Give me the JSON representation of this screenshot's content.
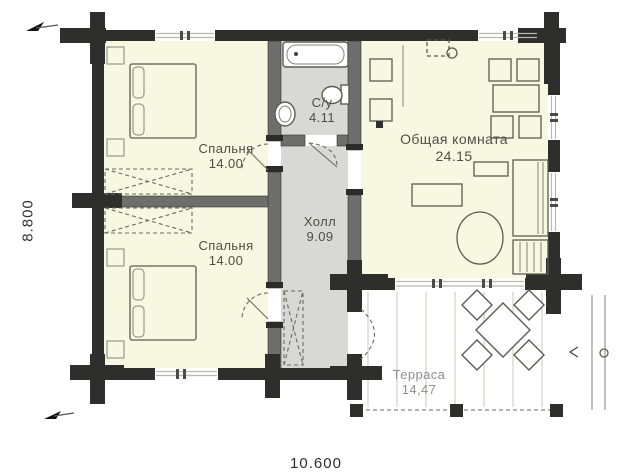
{
  "rooms": [
    {
      "name": "Спальня",
      "area": "14.00"
    },
    {
      "name": "Спальня",
      "area": "14.00"
    },
    {
      "name": "С/у",
      "area": "4.11"
    },
    {
      "name": "Холл",
      "area": "9.09"
    },
    {
      "name": "Общая комната",
      "area": "24.15"
    },
    {
      "name": "Терраса",
      "area": "14,47"
    }
  ],
  "dimensions": {
    "left": "8.800",
    "bottom": "10.600"
  },
  "colors": {
    "wall": "#2e2e2c",
    "interior_wall": "#6e6e6c",
    "room_fill": "#f8f7e2",
    "wet_room_fill": "#d8d8d4",
    "line": "#5c5c50",
    "terrace_line": "#c9c9bf",
    "label": "#4f4f44",
    "terrace_label": "#90908a",
    "dim": "#2e2e2e"
  }
}
